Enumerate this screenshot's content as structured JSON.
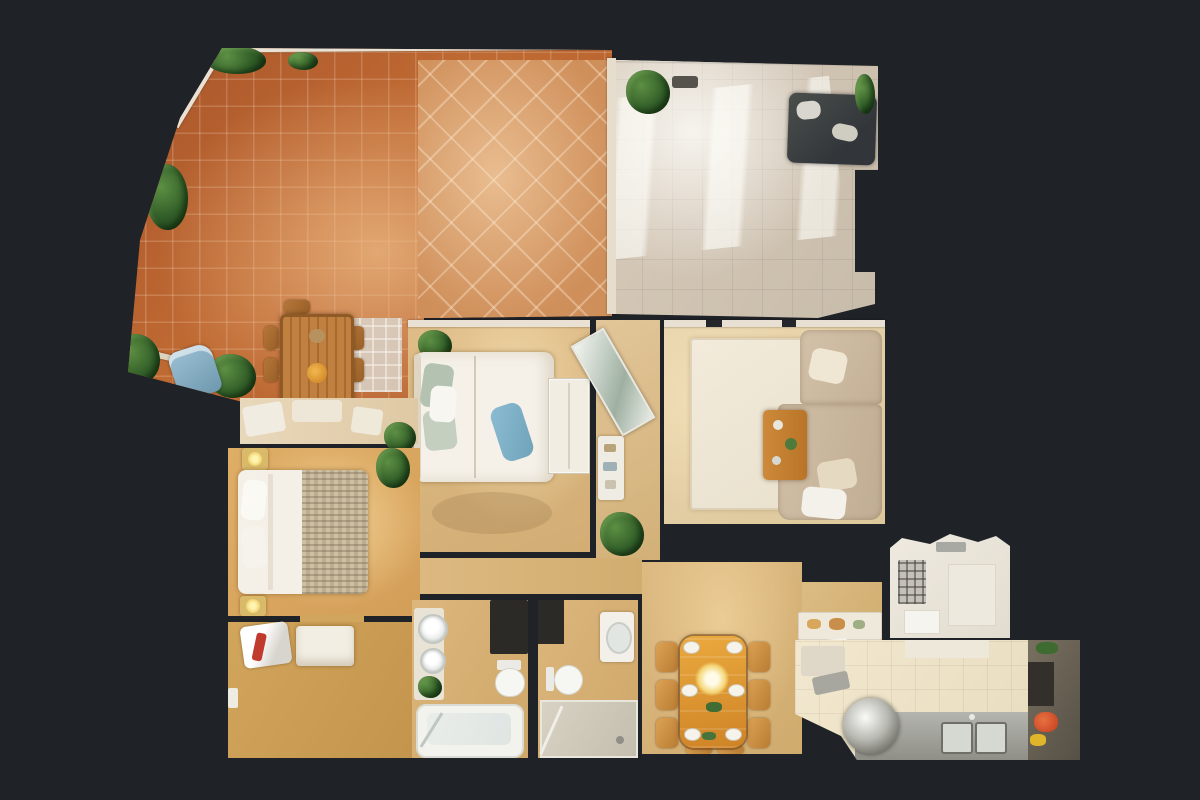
{
  "scene": {
    "type": "3d-dollhouse-floorplan",
    "view": "top-down",
    "description": "Photorealistic top-down dollhouse scan of a furnished apartment with large tiled terrace",
    "background_color": "#1f2227"
  },
  "palette": {
    "background": "#1f2227",
    "terracotta_tile": "#b05a2a",
    "terracotta_light": "#e8bd92",
    "sunroom_floor": "#cfc2b0",
    "tan_floor": "#dcba84",
    "gold_floor": "#dfae66",
    "rug_cream": "#f0e9d7",
    "sofa_beige": "#ccb9a0",
    "sofa_dark": "#3c413f",
    "wood_table": "#b97c3c",
    "dining_wood": "#e0a03c",
    "fixture_white": "#f4f3ef",
    "steel": "#a8a8a2",
    "plant_green": "#34612a",
    "accent_blue": "#7fb0c6",
    "lamp_yellow": "#ffe98a"
  },
  "rooms": {
    "terrace": {
      "label": "Terrace"
    },
    "sunroom": {
      "label": "Sunroom"
    },
    "guest_bedroom": {
      "label": "Bedroom"
    },
    "entry_hall": {
      "label": "Entry hall"
    },
    "living_room": {
      "label": "Living room"
    },
    "master_anteroom": {
      "label": "Bedroom entry"
    },
    "master_bedroom": {
      "label": "Master bedroom"
    },
    "dressing_room": {
      "label": "Dressing area"
    },
    "hallway": {
      "label": "Hallway"
    },
    "bathroom_1": {
      "label": "Bathroom"
    },
    "bathroom_2": {
      "label": "Shower room"
    },
    "dining_room": {
      "label": "Dining room"
    },
    "kitchen_pass": {
      "label": "Kitchen entry"
    },
    "utility_room": {
      "label": "Utility room"
    },
    "kitchen": {
      "label": "Kitchen"
    }
  },
  "furniture": {
    "outdoor_table": "Outdoor dining table",
    "lounge_chair": "Lounge chair",
    "dark_sofa": "Bench sofa",
    "guest_bed": "Double bed",
    "wardrobe": "Wardrobe",
    "mirror_console": "Console with mirror",
    "rug": "Area rug",
    "corner_sofa": "Corner sofa",
    "coffee_table": "Coffee table",
    "master_bed": "Double bed",
    "nightstand": "Nightstand with lamp",
    "bench": "Bench",
    "washbasin": "Washbasin",
    "bathtub": "Bathtub",
    "toilet": "Toilet",
    "shower": "Walk-in shower",
    "dining_table": "Dining table",
    "pendant_lamp": "Pendant lamp",
    "serving_counter": "Serving counter",
    "appliance": "Appliance",
    "kitchen_sink": "Kitchen sink",
    "range_hood": "Cooker hood",
    "counter": "Kitchen counter",
    "plant": "Potted plant"
  }
}
